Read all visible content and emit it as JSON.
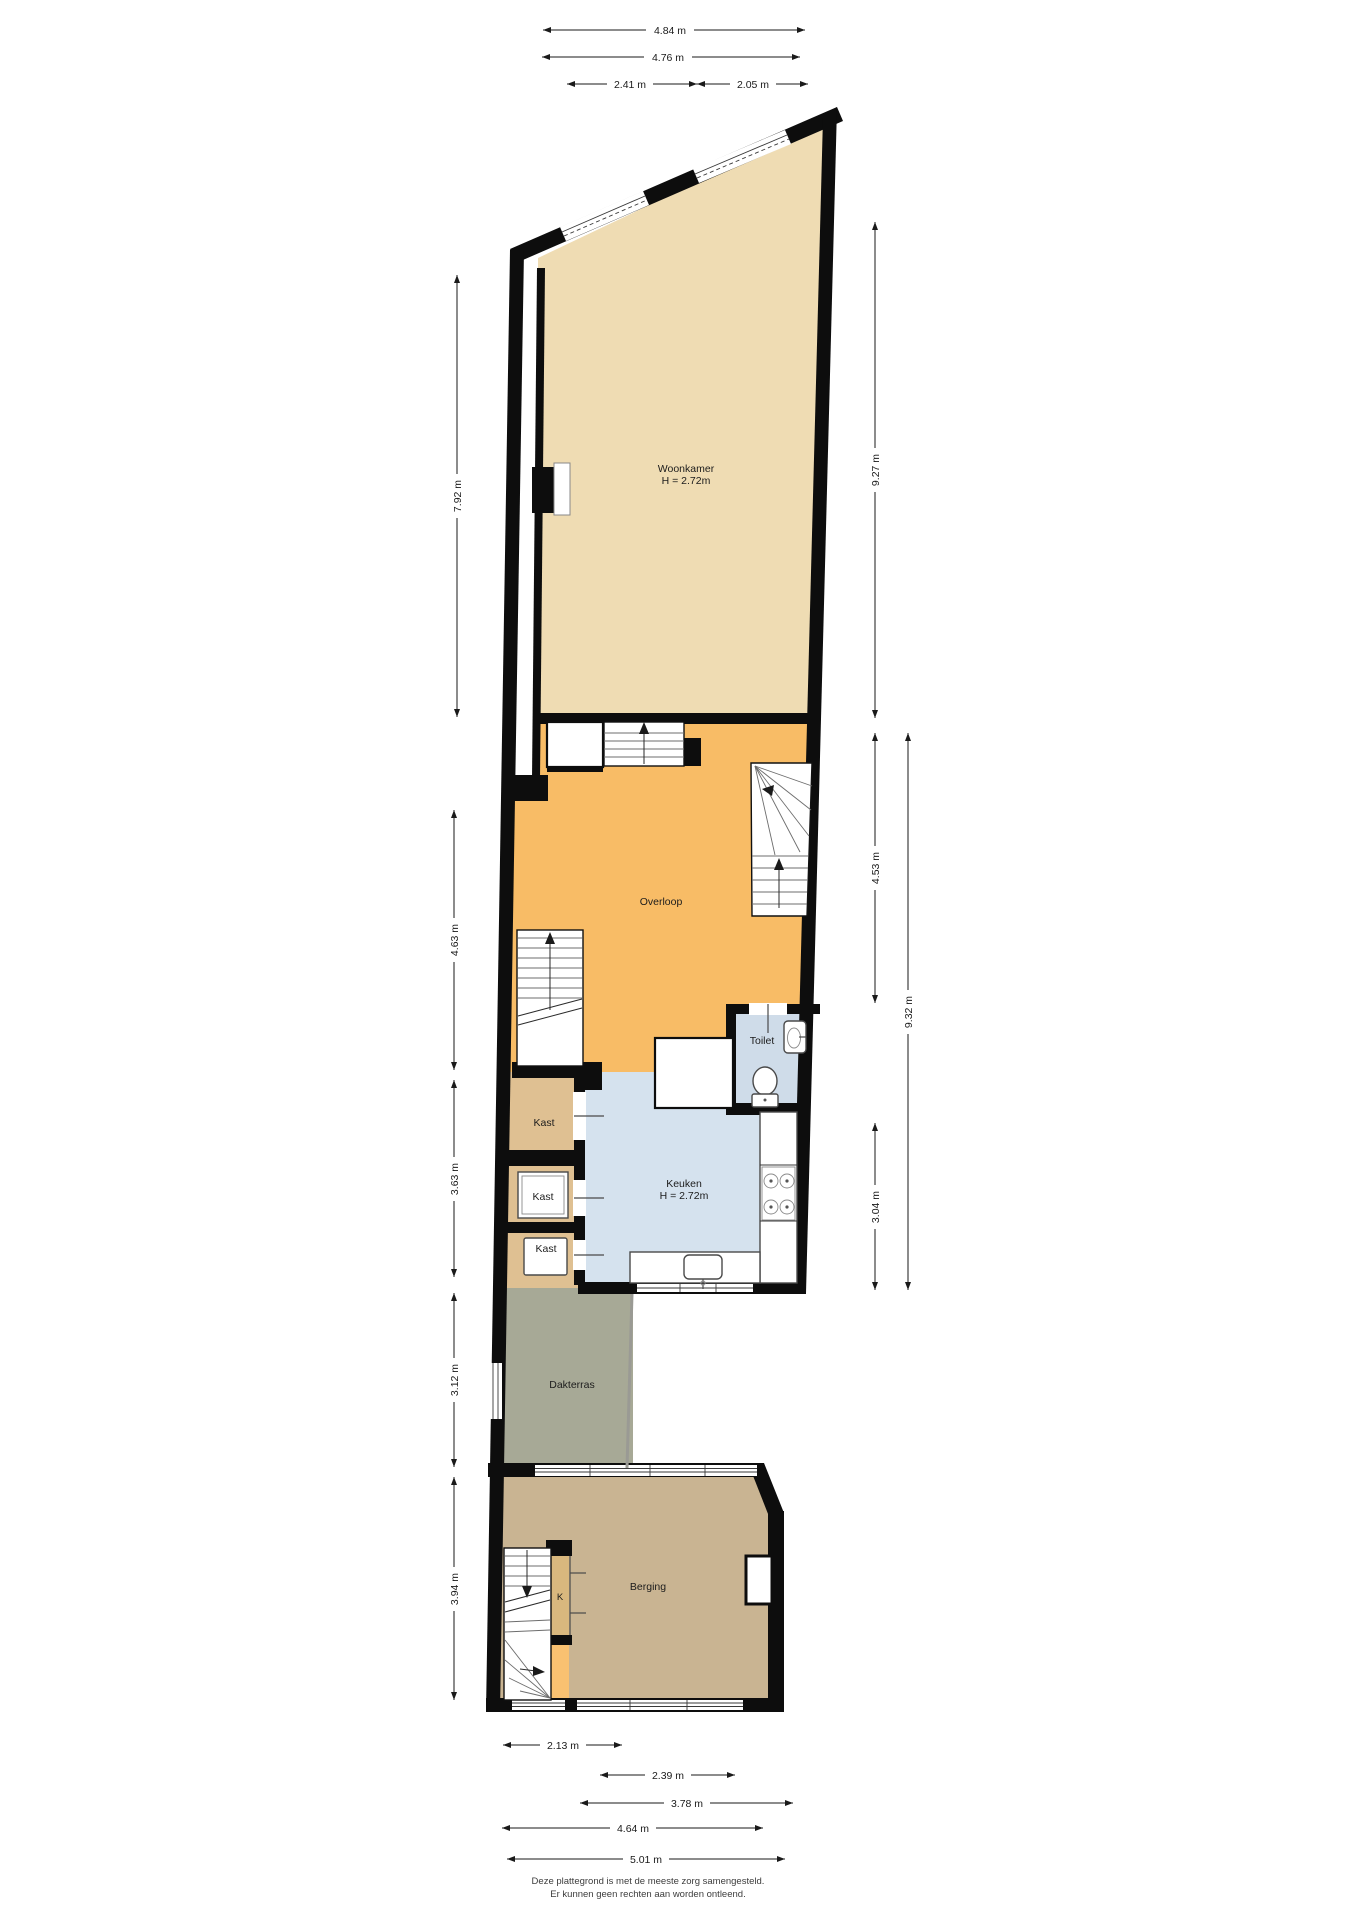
{
  "rooms": {
    "woonkamer": {
      "name": "Woonkamer",
      "height": "H = 2.72m"
    },
    "overloop": {
      "name": "Overloop"
    },
    "toilet": {
      "name": "Toilet"
    },
    "keuken": {
      "name": "Keuken",
      "height": "H = 2.72m"
    },
    "kast1": {
      "name": "Kast"
    },
    "kast2": {
      "name": "Kast"
    },
    "kast3": {
      "name": "Kast"
    },
    "kast_k": {
      "name": "K"
    },
    "dakterras": {
      "name": "Dakterras"
    },
    "berging": {
      "name": "Berging"
    }
  },
  "dims": {
    "top": [
      {
        "label": "4.84 m"
      },
      {
        "label": "4.76 m"
      },
      {
        "label": "2.41 m"
      },
      {
        "label": "2.05 m"
      }
    ],
    "left": [
      {
        "label": "7.92 m"
      },
      {
        "label": "4.63 m"
      },
      {
        "label": "3.63 m"
      },
      {
        "label": "3.12 m"
      },
      {
        "label": "3.94 m"
      }
    ],
    "right": [
      {
        "label": "9.27 m"
      },
      {
        "label": "4.53 m"
      },
      {
        "label": "9.32 m"
      },
      {
        "label": "3.04 m"
      }
    ],
    "bottom": [
      {
        "label": "2.13 m"
      },
      {
        "label": "2.39 m"
      },
      {
        "label": "3.78 m"
      },
      {
        "label": "4.64 m"
      },
      {
        "label": "5.01 m"
      }
    ]
  },
  "footer": {
    "line1": "Deze plattegrond is met de meeste zorg samengesteld.",
    "line2": "Er kunnen geen rechten aan worden ontleend."
  },
  "colors": {
    "walls": "#0d0d0d",
    "woonkamer": "#efdcb3",
    "overloop": "#f8bc66",
    "keuken": "#d5e2ee",
    "toilet": "#cfdce9",
    "kast": "#dfc092",
    "dakterras": "#a7a996",
    "berging": "#c9b492",
    "kast_k": "#d9b87e",
    "stair_landing": "#f9c171",
    "dim": "#1a1a1a"
  }
}
